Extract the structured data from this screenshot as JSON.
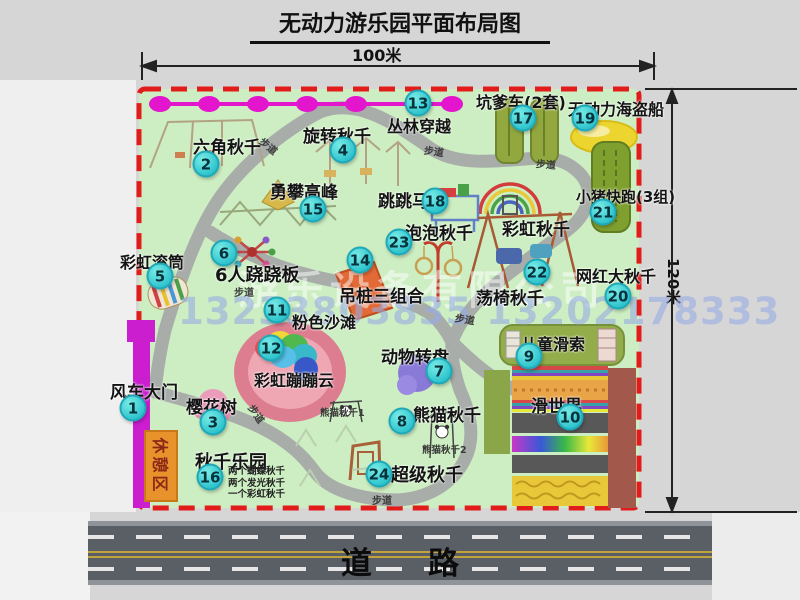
{
  "title": "无动力游乐园平面布局图",
  "dimensions": {
    "width": "100米",
    "height": "120米"
  },
  "road": {
    "label": "道路"
  },
  "path_label": "步道",
  "rest_area": "休憩区",
  "watermark": {
    "company": "游乐设备有限公司",
    "phone": "13233803835 13202178333"
  },
  "attractions": [
    {
      "num": "1",
      "label": "风车大门"
    },
    {
      "num": "2",
      "label": "六角秋千"
    },
    {
      "num": "3",
      "label": "樱花树"
    },
    {
      "num": "4",
      "label": "旋转秋千"
    },
    {
      "num": "5",
      "label": "彩虹滚筒"
    },
    {
      "num": "6",
      "label": "6人跷跷板"
    },
    {
      "num": "7",
      "label": "动物转盘"
    },
    {
      "num": "8",
      "label": "熊猫秋千"
    },
    {
      "num": "9",
      "label": "儿童滑索"
    },
    {
      "num": "10",
      "label": "滑世界"
    },
    {
      "num": "11",
      "label": "粉色沙滩"
    },
    {
      "num": "12",
      "label": "彩虹蹦蹦云"
    },
    {
      "num": "13",
      "label": "丛林穿越"
    },
    {
      "num": "14",
      "label": "吊桩三组合"
    },
    {
      "num": "15",
      "label": "勇攀高峰"
    },
    {
      "num": "16",
      "label": "秋千乐园",
      "notes": [
        "两个蝴蝶秋千",
        "两个发光秋千",
        "一个彩虹秋千"
      ]
    },
    {
      "num": "17",
      "label": "坑爹车(2套)"
    },
    {
      "num": "18",
      "label": "跳跳马"
    },
    {
      "num": "19",
      "label": "无动力海盗船"
    },
    {
      "num": "20",
      "label": "网红大秋千"
    },
    {
      "num": "21",
      "label": "小猪快跑(3组)"
    },
    {
      "num": "22",
      "label": "荡椅秋千"
    },
    {
      "num": "23",
      "label": "泡泡秋千"
    },
    {
      "num": "24",
      "label": "超级秋千"
    }
  ],
  "unnumbered_labels": {
    "rainbow_swing": "彩虹秋千",
    "panda_swing_1": "熊猫秋千1",
    "panda_swing_2": "熊猫秋千2"
  },
  "colors": {
    "park_green": "#cdeec2",
    "border_red": "#e21b1b",
    "badge_cyan": "#2cc2cc",
    "zipline_magenta": "#e316ce",
    "gate_magenta": "#cb1ecf",
    "rest_orange": "#e8922c",
    "road_gray": "#5a5f66"
  }
}
